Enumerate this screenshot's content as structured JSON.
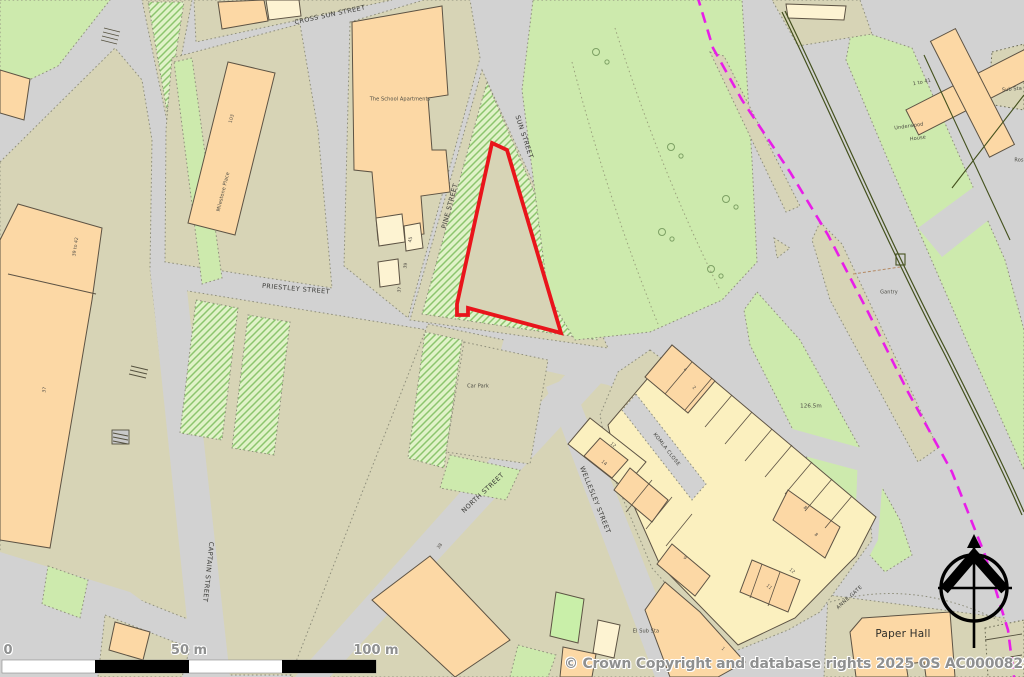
{
  "map": {
    "street_labels": {
      "cross_sun_street": "CROSS SUN STREET",
      "sun_street": "SUN STREET",
      "pine_street": "PINE STREET",
      "priestley_street": "PRIESTLEY STREET",
      "captain_street": "CAPTAIN STREET",
      "north_street": "NORTH STREET",
      "wellesley_street": "WELLESLEY STREET",
      "komla_close": "KOMLA CLOSE",
      "anne_gate": "ANNE GATE"
    },
    "place_labels": {
      "school_apartments": "The School Apartments",
      "milestone_place": "Milestone Place",
      "car_park": "Car Park",
      "paper_hall": "Paper Hall",
      "el_sub_sta": "El Sub Sta",
      "sub_sta": "Sub Sta",
      "underwood_line1": "Underwood",
      "underwood_line2": "House",
      "gantry": "Gantry",
      "ros_partial": "Ros",
      "spot_height": "126.5m"
    },
    "numbers": {
      "n103": "103",
      "n39to42": "39 to 42",
      "n37_left": "37",
      "n45": "45",
      "n39": "39",
      "n37_school": "37",
      "n38": "38",
      "n1to41": "1 to 41",
      "n12": "12",
      "n14": "14",
      "n4": "4",
      "n2": "2",
      "n9": "9",
      "n8a": "8",
      "n8b": "8",
      "n12b": "12",
      "n11": "11",
      "n1": "1"
    }
  },
  "scale_bar": {
    "tick0": "0",
    "tick50": "50 m",
    "tick100": "100 m"
  },
  "attribution": "© Crown Copyright and database rights 2025 OS AC0000829429",
  "colors": {
    "road": "#d2d2d2",
    "parcel_khaki": "#d7d4b6",
    "green": "#cdeaad",
    "hatch_green_bg": "#e0f2c8",
    "building_peach": "#fcd8a5",
    "building_cream": "#fdf3d2",
    "site_outline_red": "#e9141b",
    "boundary_magenta": "#e81ee8"
  }
}
